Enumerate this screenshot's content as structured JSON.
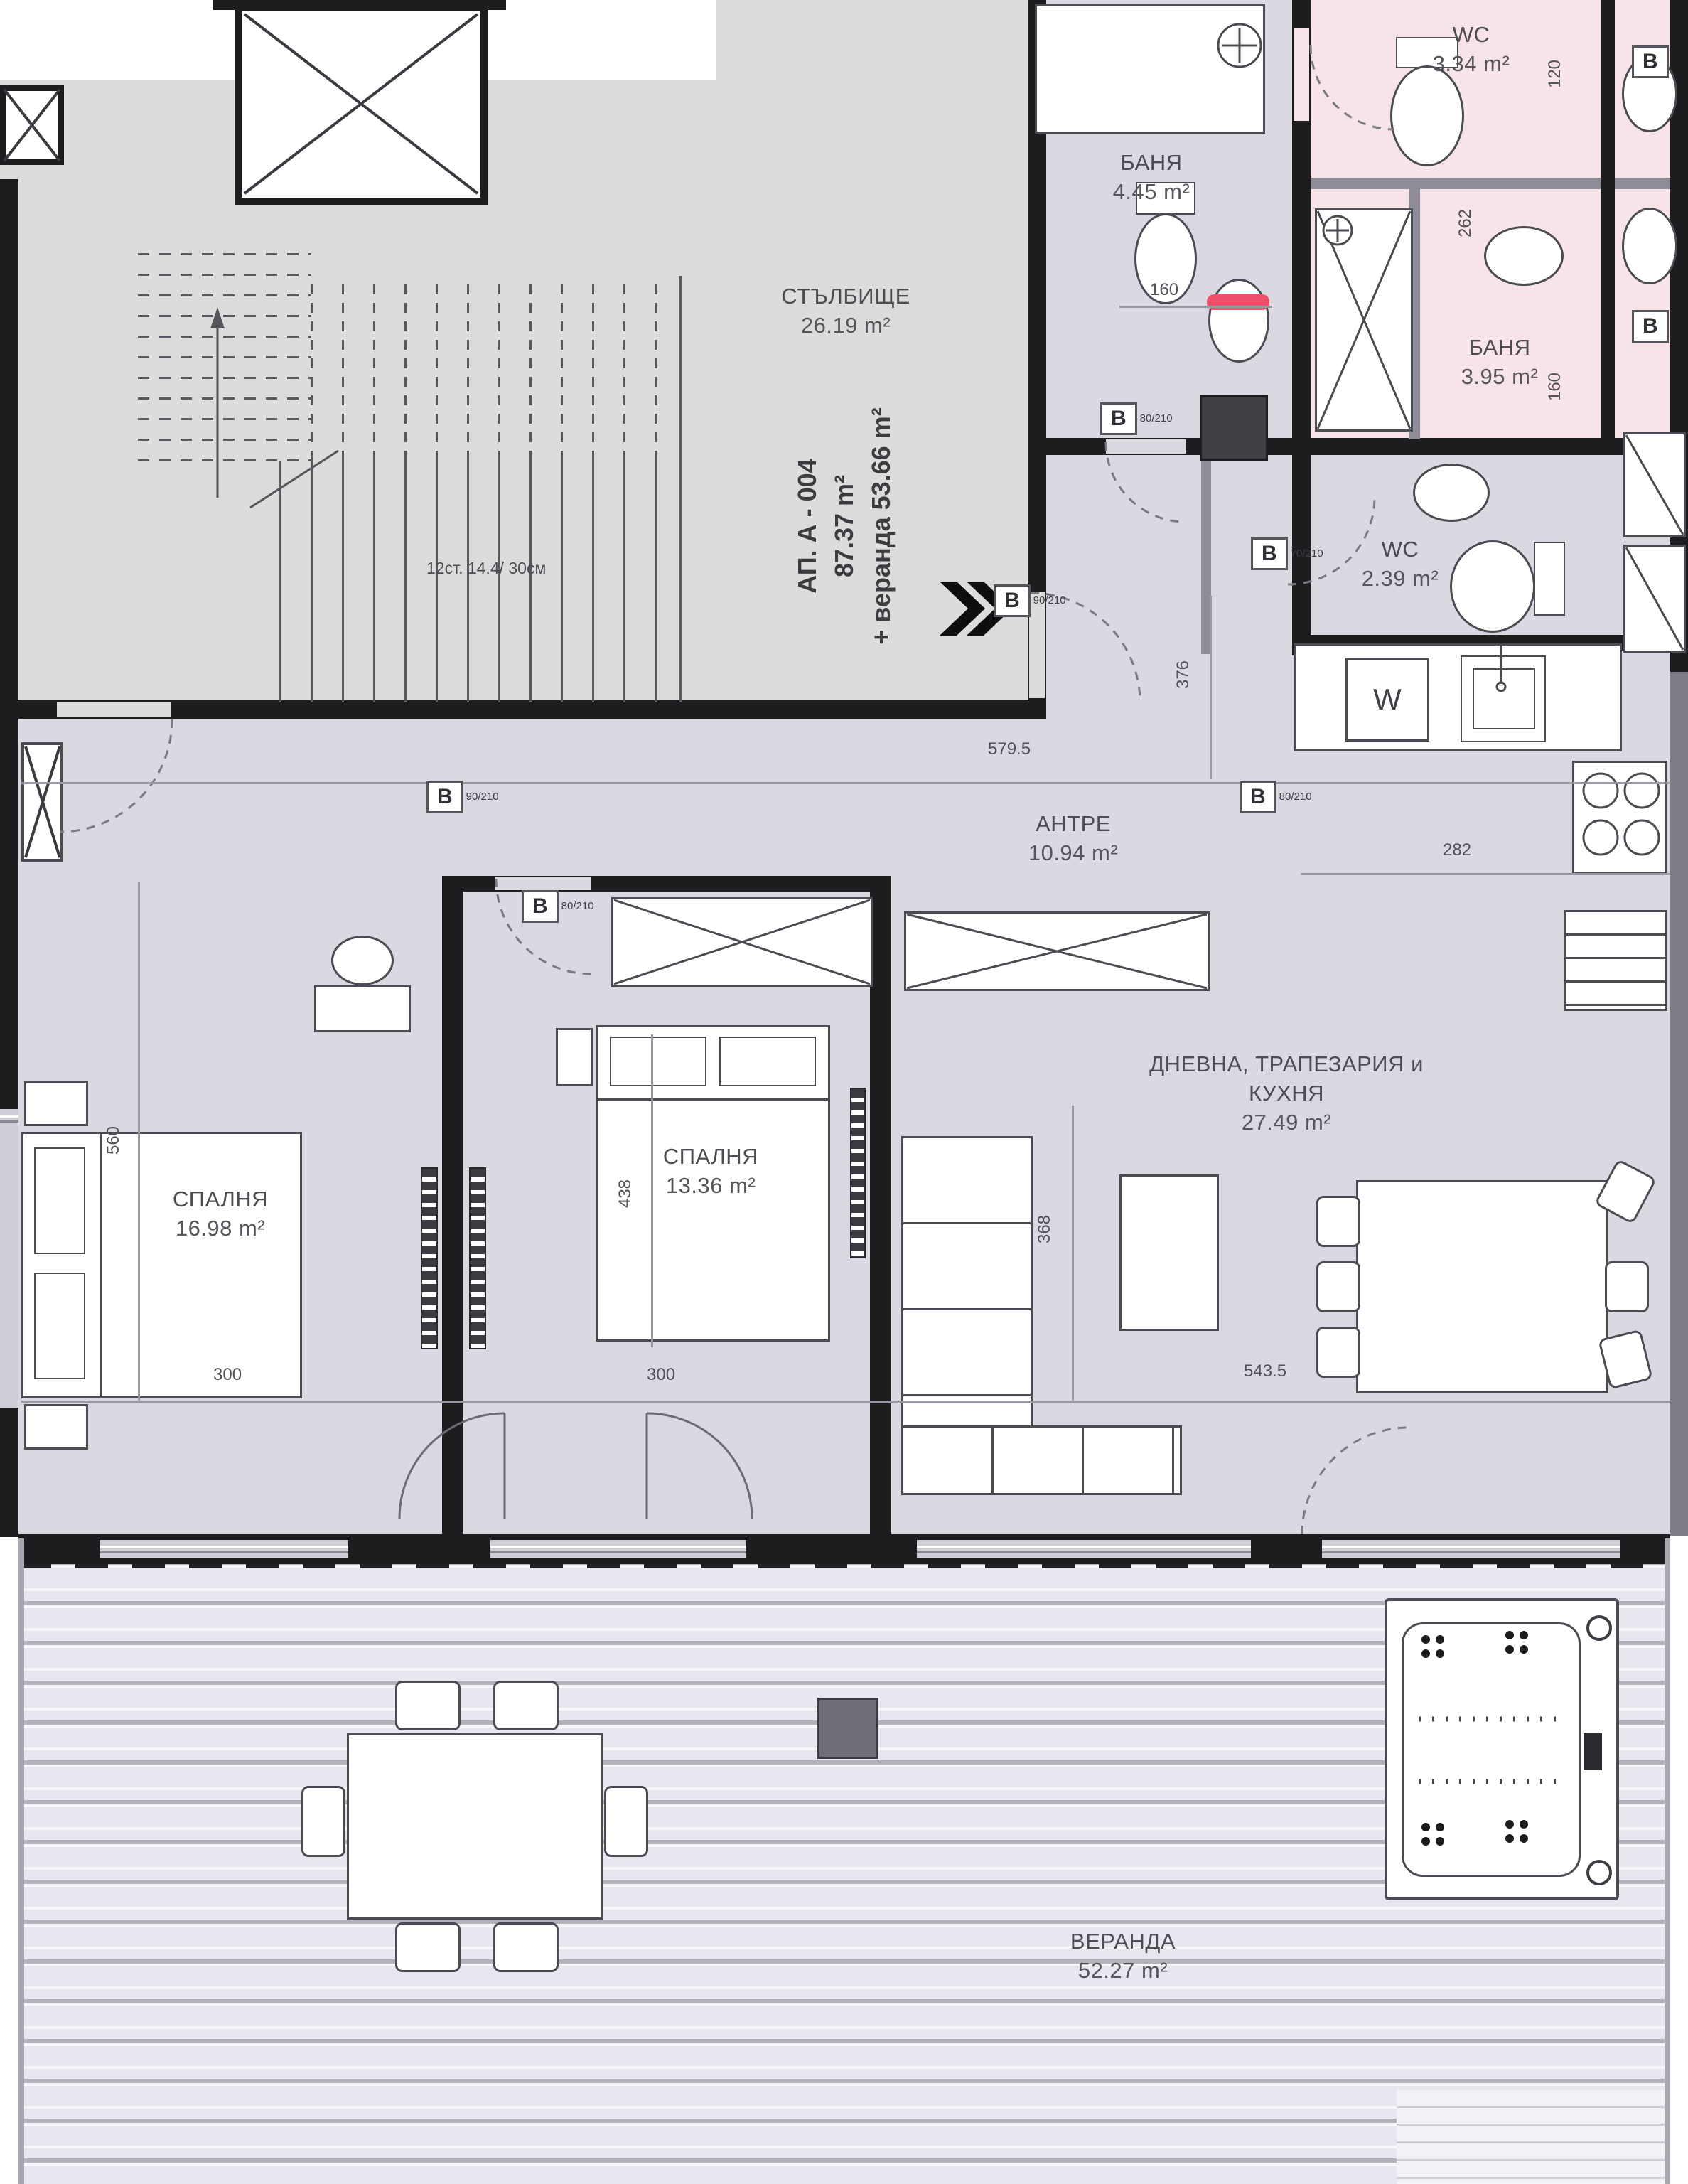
{
  "plan_title": "Apartment floor plan",
  "apartment": {
    "id": "АП. А - 004",
    "area": "87.37 m²",
    "veranda_note": "+ веранда 53.66 m²"
  },
  "rooms": {
    "staircase": {
      "name": "СТЪЛБИЩЕ",
      "area": "26.19 m²"
    },
    "bath1": {
      "name": "БАНЯ",
      "area": "4.45 m²"
    },
    "wc1": {
      "name": "WC",
      "area": "3.34 m²"
    },
    "bath2": {
      "name": "БАНЯ",
      "area": "3.95 m²"
    },
    "wc2": {
      "name": "WC",
      "area": "2.39 m²"
    },
    "hall": {
      "name": "АНТРЕ",
      "area": "10.94 m²"
    },
    "living": {
      "name_line1": "ДНЕВНА, ТРАПЕЗАРИЯ и",
      "name_line2": "КУХНЯ",
      "area": "27.49 m²"
    },
    "bedroom1": {
      "name": "СПАЛНЯ",
      "area": "16.98 m²"
    },
    "bedroom2": {
      "name": "СПАЛНЯ",
      "area": "13.36 m²"
    },
    "veranda": {
      "name": "ВЕРАНДА",
      "area": "52.27 m²"
    }
  },
  "stairs": {
    "note": "12ст. 14.4/ 30см"
  },
  "kitchen": {
    "washer_letter": "W"
  },
  "dims": {
    "hall_width": "579.5",
    "kitchen_width": "282",
    "bed1_width": "300",
    "bed2_width": "300",
    "living_width": "543.5",
    "bed1_height": "560",
    "bed2_height": "438",
    "living_height": "368",
    "hall_height": "376",
    "bath_door": "160",
    "right_top": "120",
    "right_mid": "160",
    "sink_width": "262"
  },
  "doors": {
    "front": {
      "label": "В",
      "size": "90/210"
    },
    "bath1": {
      "label": "В",
      "size": "80/210"
    },
    "wc2": {
      "label": "В",
      "size": "70/210"
    },
    "bed1": {
      "label": "В",
      "size": "90/210"
    },
    "bed2": {
      "label": "В",
      "size": "80/210"
    },
    "hall": {
      "label": "В",
      "size": "80/210"
    },
    "right1": {
      "label": "В"
    },
    "right2": {
      "label": "В"
    }
  },
  "colors": {
    "floor": "#dbd8e2",
    "wet_rooms_pink": "#f7e4e8",
    "staircase_gray": "#dcdcdc",
    "wall_dark": "#1d1d20",
    "red_marker": "#ef5069"
  }
}
